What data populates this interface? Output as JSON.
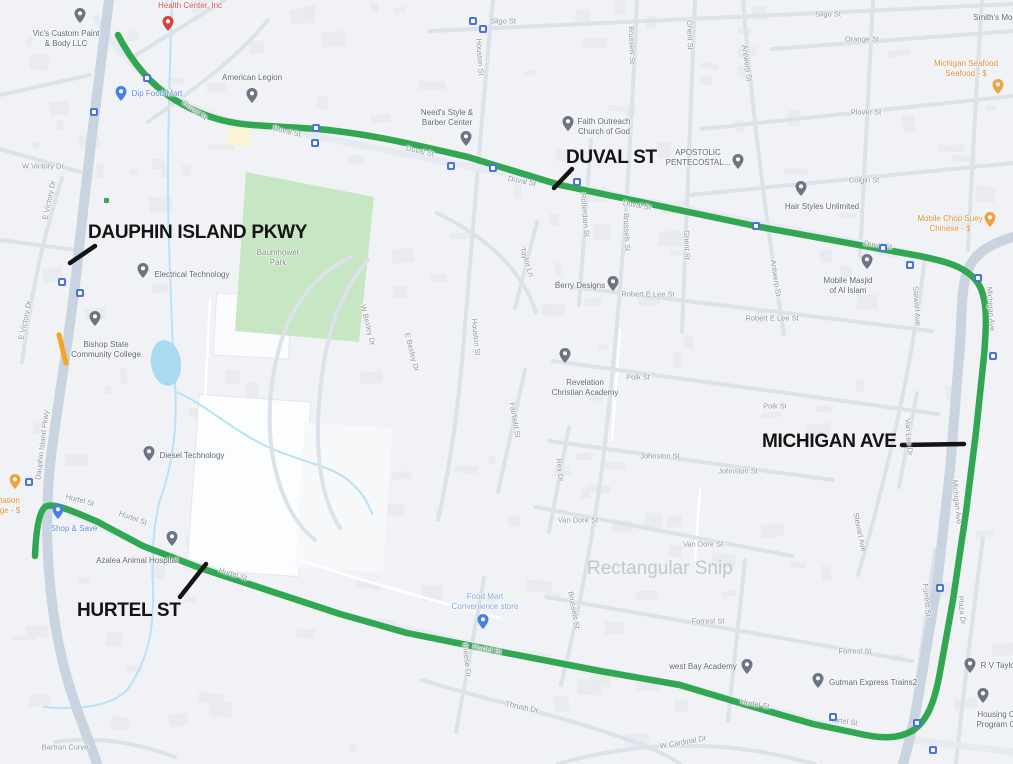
{
  "watermark": {
    "text": "Rectangular Snip",
    "x": 587,
    "y": 558
  },
  "colors": {
    "route": "#31a752",
    "annotation": "#141414",
    "watermark_gray": "#b3bdca",
    "park_fill": "#c7e6c4",
    "pond_fill": "#a8daf0",
    "creek": "#b9e2f4",
    "construction_orange": "#f6a422",
    "bus_blue": "#4b74d8"
  },
  "pin_colors": {
    "gray": "#6b7583",
    "red": "#d6453c",
    "blue": "#4a80e2",
    "lightblue": "#4a80e2",
    "orange": "#f0a33c"
  },
  "route": {
    "path": "M 118 35 C 132 62 152 88 182 104 C 207 118 228 123 252 125 L 318 129 C 372 134 420 146 468 157 L 560 185 L 760 227 L 903 253 C 945 260 972 267 981 289 C 988 306 986 330 984 356 L 976 432 L 966 512 L 953 600 L 940 672 C 935 700 928 721 912 731 C 896 740 877 738 856 733 L 813 724 L 740 703 L 680 685 L 600 671 L 507 653 L 407 633 L 340 614 L 267 590 L 200 568 L 143 546 L 98 522 C 73 511 52 502 45 507 C 39 512 36 530 35 556"
  },
  "annotations": [
    {
      "label": "DAUPHIN ISLAND PKWY",
      "x": 88,
      "y": 222,
      "line": {
        "x1": 95,
        "y1": 246,
        "x2": 70,
        "y2": 263
      }
    },
    {
      "label": "DUVAL ST",
      "x": 566,
      "y": 147,
      "line": {
        "x1": 572,
        "y1": 169,
        "x2": 554,
        "y2": 188
      }
    },
    {
      "label": "MICHIGAN AVE",
      "x": 762,
      "y": 431,
      "line": {
        "x1": 902,
        "y1": 445,
        "x2": 964,
        "y2": 444
      }
    },
    {
      "label": "HURTEL ST",
      "x": 77,
      "y": 600,
      "line": {
        "x1": 180,
        "y1": 597,
        "x2": 206,
        "y2": 564
      }
    }
  ],
  "streets": [
    {
      "text": "Sligo St",
      "x": 503,
      "y": 21
    },
    {
      "text": "Sligo St",
      "x": 828,
      "y": 14
    },
    {
      "text": "Orange St",
      "x": 862,
      "y": 39
    },
    {
      "text": "Plover St",
      "x": 866,
      "y": 112
    },
    {
      "text": "Colgin St",
      "x": 864,
      "y": 180
    },
    {
      "text": "W Victory Dr",
      "x": 43,
      "y": 166
    },
    {
      "text": "E Victory Dr",
      "x": 49,
      "y": 200,
      "rot": -78
    },
    {
      "text": "E Victory Dr",
      "x": 25,
      "y": 320,
      "rot": -78
    },
    {
      "text": "Dauphin Island Pkwy",
      "x": 42,
      "y": 445,
      "rot": -83
    },
    {
      "text": "Houston St",
      "x": 480,
      "y": 57,
      "rot": 86
    },
    {
      "text": "Houston St",
      "x": 476,
      "y": 337,
      "rot": 84
    },
    {
      "text": "Brussels St",
      "x": 632,
      "y": 45,
      "rot": 88
    },
    {
      "text": "Brussels St",
      "x": 627,
      "y": 232,
      "rot": 88
    },
    {
      "text": "Brussels St",
      "x": 574,
      "y": 610,
      "rot": 80
    },
    {
      "text": "Rotterdam St",
      "x": 585,
      "y": 215,
      "rot": 85
    },
    {
      "text": "Ghent St",
      "x": 690,
      "y": 35,
      "rot": 88
    },
    {
      "text": "Ghent St",
      "x": 687,
      "y": 245,
      "rot": 88
    },
    {
      "text": "Antwerp St",
      "x": 747,
      "y": 63,
      "rot": 82
    },
    {
      "text": "Antwerp St",
      "x": 776,
      "y": 278,
      "rot": 82
    },
    {
      "text": "Taylor Ln",
      "x": 527,
      "y": 262,
      "rot": 72
    },
    {
      "text": "Robert E Lee St",
      "x": 648,
      "y": 294
    },
    {
      "text": "Robert E Lee St",
      "x": 772,
      "y": 318
    },
    {
      "text": "Polk St",
      "x": 638,
      "y": 377
    },
    {
      "text": "Polk St",
      "x": 775,
      "y": 406
    },
    {
      "text": "Johnston St",
      "x": 660,
      "y": 456
    },
    {
      "text": "Johnston St",
      "x": 738,
      "y": 471
    },
    {
      "text": "Van Dore St",
      "x": 578,
      "y": 520
    },
    {
      "text": "Van Dore St",
      "x": 703,
      "y": 544
    },
    {
      "text": "Forrest St",
      "x": 708,
      "y": 621
    },
    {
      "text": "Forrest St",
      "x": 855,
      "y": 651
    },
    {
      "text": "Forrest St",
      "x": 927,
      "y": 600,
      "rot": 84
    },
    {
      "text": "Stewart Ave",
      "x": 917,
      "y": 306,
      "rot": 86
    },
    {
      "text": "Stewart Ave",
      "x": 860,
      "y": 532,
      "rot": 78
    },
    {
      "text": "Michigan Ave",
      "x": 991,
      "y": 309,
      "rot": 86
    },
    {
      "text": "Michigan Ave",
      "x": 957,
      "y": 502,
      "rot": 84
    },
    {
      "text": "Plaza Dr",
      "x": 962,
      "y": 610,
      "rot": 84
    },
    {
      "text": "Van Lee Dr",
      "x": 909,
      "y": 437,
      "rot": 86
    },
    {
      "text": "Rex Dr",
      "x": 560,
      "y": 470,
      "rot": 84
    },
    {
      "text": "Fairfield St",
      "x": 515,
      "y": 420,
      "rot": 80
    },
    {
      "text": "W Bexley Dr",
      "x": 368,
      "y": 325,
      "rot": 76
    },
    {
      "text": "E Bexley Dr",
      "x": 412,
      "y": 352,
      "rot": 76
    },
    {
      "text": "Hurtel St",
      "x": 80,
      "y": 500,
      "rot": 15
    },
    {
      "text": "Hurtel St",
      "x": 133,
      "y": 518,
      "rot": 20
    },
    {
      "text": "Hurtel St",
      "x": 233,
      "y": 574,
      "rot": 17
    },
    {
      "text": "Hurtel St",
      "x": 487,
      "y": 649,
      "rot": 11
    },
    {
      "text": "Hurtel St",
      "x": 755,
      "y": 704,
      "rot": 10
    },
    {
      "text": "Hurtel St",
      "x": 843,
      "y": 721,
      "rot": 8
    },
    {
      "text": "Duval St",
      "x": 195,
      "y": 110,
      "rot": 36
    },
    {
      "text": "Duval St",
      "x": 287,
      "y": 131,
      "rot": 14
    },
    {
      "text": "Duval St",
      "x": 420,
      "y": 151,
      "rot": 12
    },
    {
      "text": "Duval St",
      "x": 522,
      "y": 181,
      "rot": 11
    },
    {
      "text": "Duval St",
      "x": 637,
      "y": 205,
      "rot": 10
    },
    {
      "text": "Duval St",
      "x": 878,
      "y": 245,
      "rot": 8
    },
    {
      "text": "W Cardinal Dr",
      "x": 683,
      "y": 742,
      "rot": -10
    },
    {
      "text": "Bartran Curve",
      "x": 65,
      "y": 747
    },
    {
      "text": "Thrush Dr",
      "x": 522,
      "y": 707,
      "rot": 12
    },
    {
      "text": "Breese Dr",
      "x": 467,
      "y": 660,
      "rot": 84
    }
  ],
  "pois": [
    {
      "name": "vics-custom-paint-body",
      "type": "gray",
      "pin": [
        80,
        17
      ],
      "lx": 66,
      "ly": 29,
      "lines": [
        "Vic's Custom Paint",
        "& Body LLC"
      ]
    },
    {
      "name": "health-center",
      "type": "red",
      "pin": [
        168,
        25
      ],
      "lx": 190,
      "ly": 1,
      "lines": [
        "Health Center, Inc"
      ]
    },
    {
      "name": "dip-food-mart",
      "type": "blue",
      "pin": [
        121,
        95
      ],
      "lx": 157,
      "ly": 89,
      "lines": [
        "Dip Food Mart"
      ]
    },
    {
      "name": "american-legion",
      "type": "gray",
      "pin": [
        252,
        97
      ],
      "lx": 252,
      "ly": 73,
      "lines": [
        "American Legion"
      ]
    },
    {
      "name": "needs-style-barber",
      "type": "gray",
      "pin": [
        466,
        140
      ],
      "lx": 447,
      "ly": 108,
      "lines": [
        "Need's Style &",
        "Barber Center"
      ]
    },
    {
      "name": "faith-outreach-church",
      "type": "gray",
      "pin": [
        568,
        125
      ],
      "lx": 604,
      "ly": 117,
      "lines": [
        "Faith Outreach",
        "Church of God"
      ]
    },
    {
      "name": "apostolic-pentecostal",
      "type": "gray",
      "pin": [
        738,
        163
      ],
      "lx": 698,
      "ly": 148,
      "lines": [
        "APOSTOLIC",
        "PENTECOSTAL..."
      ]
    },
    {
      "name": "hair-styles-unlimited",
      "type": "gray",
      "pin": [
        801,
        190
      ],
      "lx": 822,
      "ly": 202,
      "lines": [
        "Hair Styles Unlimited"
      ]
    },
    {
      "name": "michigan-seafood",
      "type": "orange",
      "pin": [
        998,
        88
      ],
      "lx": 966,
      "ly": 59,
      "lines": [
        "Michigan Seafood",
        "Seafood - $"
      ]
    },
    {
      "name": "mobile-chop-suey",
      "type": "orange",
      "pin": [
        990,
        221
      ],
      "lx": 950,
      "ly": 214,
      "lines": [
        "Mobile Chop Suey",
        "Chinese - $"
      ]
    },
    {
      "name": "smiths-mon",
      "type": "gray",
      "pin": null,
      "lx": 995,
      "ly": 13,
      "lines": [
        "Smith's Mon"
      ]
    },
    {
      "name": "mobile-masjid",
      "type": "gray",
      "pin": [
        867,
        263
      ],
      "lx": 848,
      "ly": 276,
      "lines": [
        "Mobile Masjid",
        "of Al Islam"
      ]
    },
    {
      "name": "berry-designs",
      "type": "gray",
      "pin": [
        613,
        285
      ],
      "lx": 580,
      "ly": 281,
      "lines": [
        "Berry Designs"
      ]
    },
    {
      "name": "revelation-christian-academy",
      "type": "gray",
      "pin": [
        565,
        357
      ],
      "lx": 585,
      "ly": 378,
      "lines": [
        "Revelation",
        "Christian Academy"
      ]
    },
    {
      "name": "electrical-technology",
      "type": "gray",
      "pin": [
        143,
        272
      ],
      "lx": 192,
      "ly": 270,
      "lines": [
        "Electrical Technology"
      ]
    },
    {
      "name": "bishop-state-college",
      "type": "gray",
      "pin": [
        95,
        320
      ],
      "lx": 106,
      "ly": 340,
      "lines": [
        "Bishop State",
        "Community College"
      ]
    },
    {
      "name": "diesel-technology",
      "type": "gray",
      "pin": [
        149,
        455
      ],
      "lx": 192,
      "ly": 451,
      "lines": [
        "Diesel Technology"
      ]
    },
    {
      "name": "baumhower-park",
      "type": "green",
      "pin": null,
      "lx": 278,
      "ly": 248,
      "lines": [
        "Baumhower",
        "Park"
      ]
    },
    {
      "name": "azalea-animal-hospital",
      "type": "gray",
      "pin": [
        172,
        540
      ],
      "lx": 137,
      "ly": 556,
      "lines": [
        "Azalea Animal Hospital"
      ]
    },
    {
      "name": "shop-and-save",
      "type": "blue",
      "pin": [
        58,
        513
      ],
      "lx": 74,
      "ly": 524,
      "lines": [
        "Shop & Save"
      ]
    },
    {
      "name": "station",
      "type": "orange",
      "pin": [
        15,
        483
      ],
      "lx": 10,
      "ly": 496,
      "lines": [
        "tation",
        "ge - $"
      ]
    },
    {
      "name": "food-mart-convenience",
      "type": "lightblue",
      "pin": [
        483,
        623
      ],
      "lx": 485,
      "ly": 592,
      "lines": [
        "Food Mart",
        "Convenience store"
      ]
    },
    {
      "name": "west-bay-academy",
      "type": "gray",
      "pin": [
        747,
        668
      ],
      "lx": 703,
      "ly": 662,
      "lines": [
        "west Bay Academy"
      ]
    },
    {
      "name": "gutman-express-trains",
      "type": "gray",
      "pin": [
        818,
        682
      ],
      "lx": 873,
      "ly": 678,
      "lines": [
        "Gutman Express Trains2"
      ]
    },
    {
      "name": "rv-taylor",
      "type": "gray",
      "pin": [
        970,
        667
      ],
      "lx": 999,
      "ly": 661,
      "lines": [
        "R V Taylor"
      ]
    },
    {
      "name": "housing-program",
      "type": "gray",
      "pin": [
        983,
        697
      ],
      "lx": 996,
      "ly": 710,
      "lines": [
        "Housing C",
        "Program O"
      ]
    }
  ],
  "bus_stops": [
    [
      147,
      78
    ],
    [
      94,
      112
    ],
    [
      316,
      128
    ],
    [
      315,
      143
    ],
    [
      473,
      21
    ],
    [
      483,
      29
    ],
    [
      451,
      166
    ],
    [
      493,
      168
    ],
    [
      577,
      182
    ],
    [
      756,
      226
    ],
    [
      883,
      248
    ],
    [
      910,
      265
    ],
    [
      978,
      278
    ],
    [
      993,
      356
    ],
    [
      940,
      588
    ],
    [
      917,
      723
    ],
    [
      933,
      750
    ],
    [
      29,
      482
    ],
    [
      62,
      282
    ],
    [
      80,
      293
    ],
    [
      833,
      717
    ]
  ]
}
